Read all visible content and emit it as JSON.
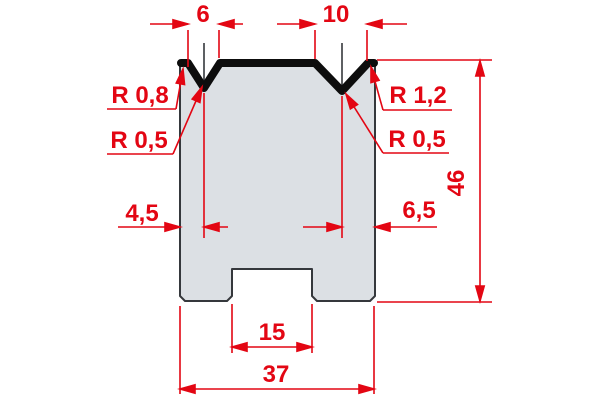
{
  "colors": {
    "dimension_red": "#e30613",
    "body_fill": "#dce0e4",
    "outline_dark": "#35383c",
    "profile_black": "#0d0d0d",
    "background": "#ffffff"
  },
  "labels": {
    "v_left_width": "6",
    "v_right_width": "10",
    "radius_left_outer": "R 0,8",
    "radius_left_groove": "R 0,5",
    "radius_right_outer": "R 1,2",
    "radius_right_groove": "R 0,5",
    "offset_left": "4,5",
    "offset_right": "6,5",
    "height_total": "46",
    "slot_width": "15",
    "width_total": "37"
  }
}
